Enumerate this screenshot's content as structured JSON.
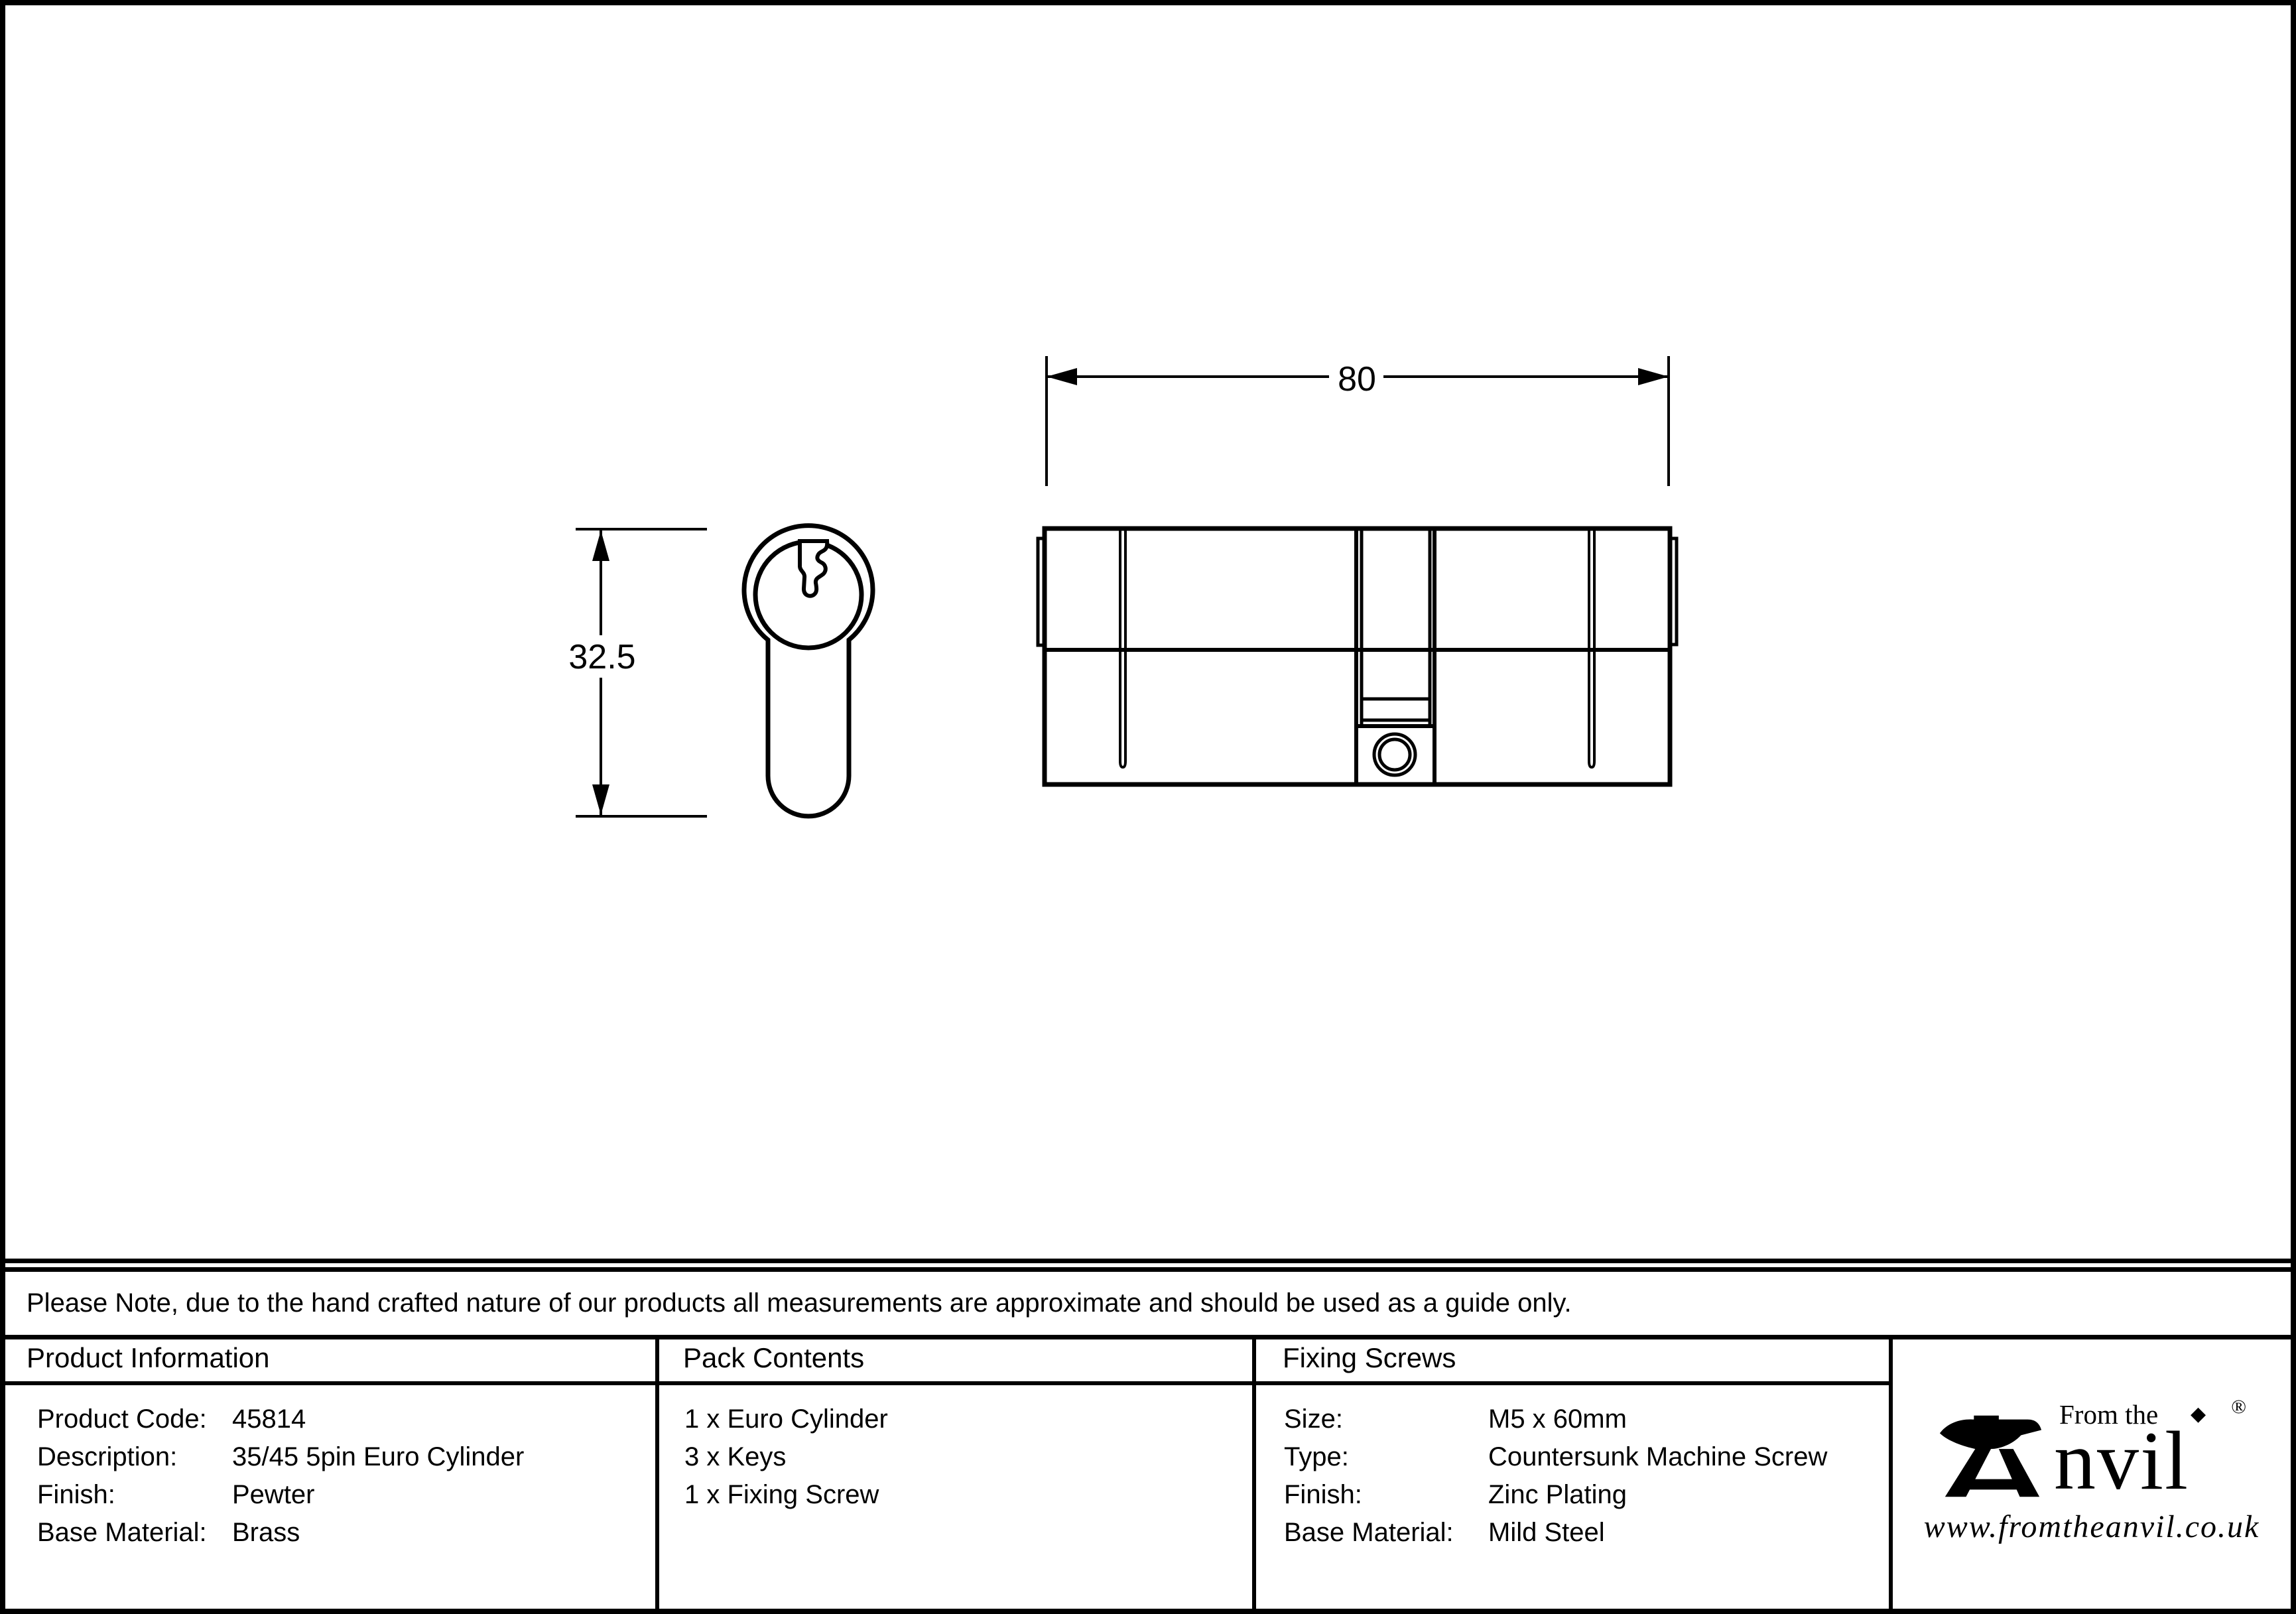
{
  "page": {
    "background": "#ffffff",
    "ink": "#000000"
  },
  "drawing": {
    "dim_width_label": "80",
    "dim_height_label": "32.5"
  },
  "note": {
    "text": "Please Note, due to the hand crafted nature of our products all measurements are approximate and should be used as a guide only."
  },
  "product_information": {
    "header": "Product Information",
    "rows": [
      {
        "label": "Product Code:",
        "value": "45814"
      },
      {
        "label": "Description:",
        "value": "35/45 5pin Euro Cylinder"
      },
      {
        "label": "Finish:",
        "value": "Pewter"
      },
      {
        "label": "Base Material:",
        "value": "Brass"
      }
    ]
  },
  "pack_contents": {
    "header": "Pack Contents",
    "items": [
      "1 x Euro Cylinder",
      "3 x Keys",
      "1 x Fixing Screw"
    ]
  },
  "fixing_screws": {
    "header": "Fixing Screws",
    "rows": [
      {
        "label": "Size:",
        "value": "M5 x 60mm"
      },
      {
        "label": "Type:",
        "value": "Countersunk Machine Screw"
      },
      {
        "label": "Finish:",
        "value": "Zinc Plating"
      },
      {
        "label": "Base Material:",
        "value": "Mild Steel"
      }
    ]
  },
  "logo": {
    "tagline": "From the",
    "diamond": "◆",
    "brand_suffix": "nvil",
    "registered": "®",
    "url": "www.fromtheanvil.co.uk"
  }
}
